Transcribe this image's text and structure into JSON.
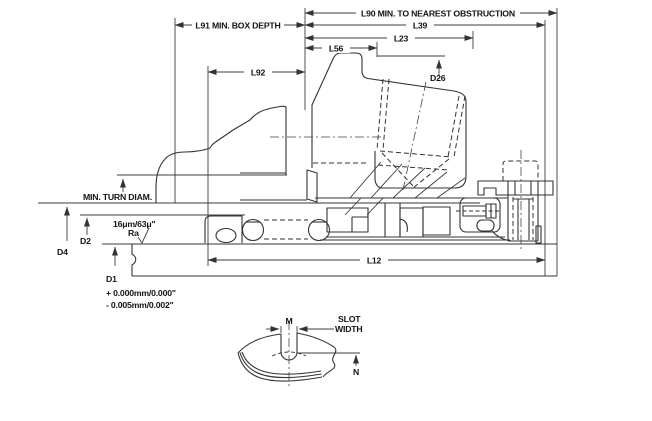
{
  "drawing": {
    "type": "technical-cross-section",
    "colors": {
      "line": "#333333",
      "text": "#141414",
      "background": "#ffffff"
    },
    "dims": {
      "l90": "L90 MIN. TO NEAREST OBSTRUCTION",
      "l39": "L39",
      "l23": "L23",
      "l56": "L56",
      "l91": "L91 MIN. BOX DEPTH",
      "l92": "L92",
      "l12": "L12",
      "d26": "D26",
      "d4": "D4",
      "d2": "D2",
      "d1": "D1",
      "min_turn_diam": "MIN. TURN DIAM.",
      "surface_finish": "16μm/63μ\"",
      "surface_finish_unit": "Ra",
      "d1_tolerance_plus": "+ 0.000mm/0.000\"",
      "d1_tolerance_minus": "- 0.005mm/0.002\"",
      "m": "M",
      "n": "N",
      "slot_width_line1": "SLOT",
      "slot_width_line2": "WIDTH"
    }
  }
}
